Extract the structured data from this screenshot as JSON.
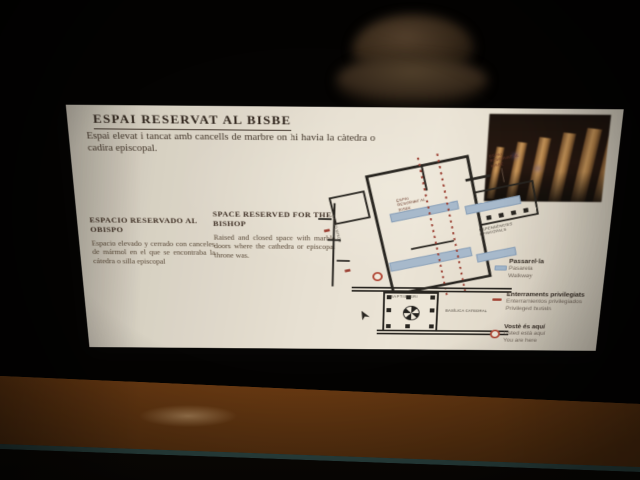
{
  "panel": {
    "title": "ESPAI RESERVAT AL BISBE",
    "intro_catalan": "Espai elevat i tancat amb cancells de marbre on hi havia la càtedra o cadira episcopal.",
    "spanish": {
      "heading": "ESPACIO RESERVADO AL OBISPO",
      "body": "Espacio elevado y cerrado con canceles de mármol en el que se encontraba la cátedra o silla episcopal"
    },
    "english": {
      "heading": "SPACE RESERVED FOR THE BISHOP",
      "body": "Raised and closed space with marble doors where the cathedra or episcopal throne was."
    }
  },
  "map": {
    "labels": {
      "subject": "ESPAI RESERVAT AL BISBE",
      "subject_callout": "ESPAI RESERVAT AL BISBE",
      "street": "CARDO MINOR",
      "annex": "DEPENDÈNCIES EPISCOPALS",
      "baptistery": "BAPTISTERI",
      "basilica": "BASÍLICA CATEDRAL"
    },
    "legend": [
      {
        "label_ca": "Passarel·la",
        "label_es": "Pasarela",
        "label_en": "Walkway",
        "icon": "walkway-swatch",
        "color": "#9cb8d6"
      },
      {
        "label_ca": "Enterraments privilegiats",
        "label_es": "Enterramientos privilegiados",
        "label_en": "Privileged burials",
        "icon": "burials-dash",
        "color": "#ac3a2a"
      },
      {
        "label_ca": "Vostè és aquí",
        "label_es": "Usted está aquí",
        "label_en": "You are here",
        "icon": "you-are-here-ring",
        "color": "#c0402e"
      }
    ]
  },
  "colors": {
    "background": "#040302",
    "panel": "#e9e5dc",
    "wall": "#211e19",
    "walkway_blue": "#a2bcd9",
    "burial_red": "#ac3a2a",
    "rail_wood": "#a9661f",
    "title_text": "#2a1d14"
  }
}
